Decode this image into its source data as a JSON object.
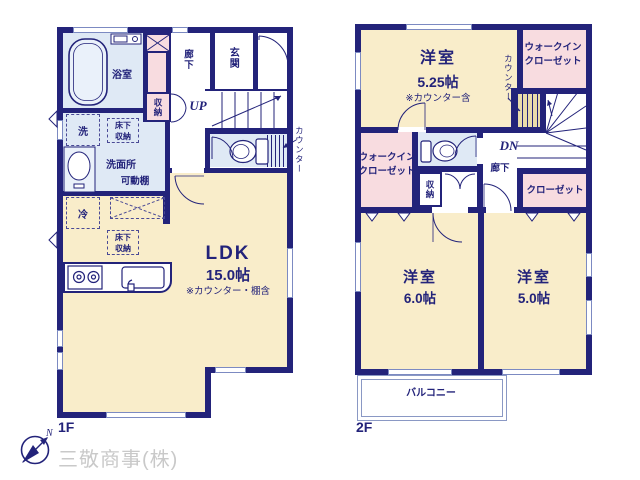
{
  "company": "三敬商事(株)",
  "compass": {
    "north": "N"
  },
  "colors": {
    "wall": "#23237a",
    "room_cream": "#f9edca",
    "closet_pink": "#f8dce0",
    "wet_blue": "#dfe9f5",
    "company_gray": "#c9c9c9"
  },
  "floor1": {
    "label": "1F",
    "bathroom": "浴室",
    "corridor": "廊下",
    "entrance": "玄関",
    "storage": "収納",
    "up": "UP",
    "washer": "洗",
    "underfloor_storage": [
      "床下",
      "収納"
    ],
    "washroom": "洗面所",
    "movable_shelf": "可動棚",
    "counter": "カウンター",
    "fridge": "冷",
    "underfloor_storage2": [
      "床下",
      "収納"
    ],
    "ldk": {
      "name": "LDK",
      "size": "15.0帖",
      "note": "※カウンター・棚含"
    }
  },
  "floor2": {
    "label": "2F",
    "room_525": {
      "name": "洋室",
      "size": "5.25帖",
      "note": "※カウンター含"
    },
    "wic_top": [
      "ウォークイン",
      "クローゼット"
    ],
    "counter": "カウンター",
    "dn": "DN",
    "corridor": "廊下",
    "storage": "収納",
    "wic_left": [
      "ウォークイン",
      "クローゼット"
    ],
    "closet": "クローゼット",
    "room_60": {
      "name": "洋室",
      "size": "6.0帖"
    },
    "room_50": {
      "name": "洋室",
      "size": "5.0帖"
    },
    "balcony": "バルコニー"
  }
}
